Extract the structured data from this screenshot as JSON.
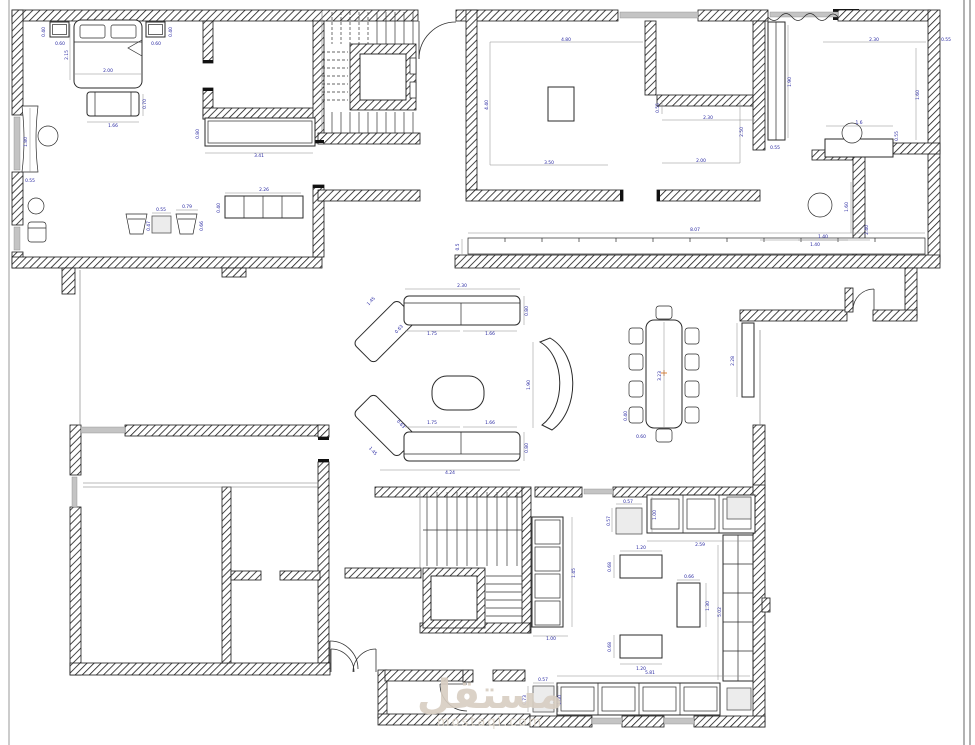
{
  "watermark": {
    "title": "مستقل",
    "domain": "mostaql.com"
  },
  "colors": {
    "dim_text": "#1f1f9e",
    "watermark": "#d8cec2",
    "center_mark": "#e0761f",
    "wall_hatch": "#1a1a1a"
  },
  "dims": {
    "bedroom": {
      "nightstand_l_d": "0.40",
      "nightstand_l_w": "0.60",
      "bed_l": "2.15",
      "bed_w": "2.00",
      "nightstand_r_w": "0.60",
      "nightstand_r_d": "0.40",
      "bench_d": "0.70",
      "bench_w": "1.66",
      "vanity_l": "1.80",
      "vanity_d": "0.55",
      "console_d": "0.80",
      "console_l": "3.41",
      "cabinet_w": "2.26",
      "cabinet_d": "0.40",
      "table_w": "0.55",
      "table_d": "0.47",
      "armchair_w": "0.79",
      "armchair_d": "0.66"
    },
    "majlis": {
      "width": "4.80",
      "height": "4.40",
      "inner": "3.50"
    },
    "closet": {
      "depth": "0.55",
      "width": "2.30",
      "height": "2.50",
      "inner": "2.00"
    },
    "dressing": {
      "width": "2.30",
      "corner": "0.55",
      "height": "1.60",
      "wardrobe_l": "1.90",
      "wardrobe_d": "0.55",
      "vanity_w": "1.6",
      "vanity_d": "0.55"
    },
    "bath": {
      "width": "1.40",
      "depth": "1.60",
      "wall": "2.40"
    },
    "corridor": {
      "length": "8.07",
      "depth": "0.5"
    },
    "vestibule": {
      "width": "1.40"
    },
    "living": {
      "sofa_top": "2.30",
      "diag": "1.45",
      "elbow": "0.63",
      "seat1": "1.75",
      "seat2": "1.66",
      "depth": "0.80",
      "diagb": "1.45",
      "elbowb": "0.63",
      "seat1b": "1.75",
      "seat2b": "1.66",
      "depthb": "0.80",
      "total": "4.24",
      "bench": "1.90"
    },
    "dining": {
      "length": "3.23",
      "chair_w": "0.40",
      "chair_d": "0.60",
      "sideboard": "2.28"
    },
    "kitchen": {
      "appl_w": "0.57",
      "appl_d": "0.57",
      "counter_d": "1.00",
      "top_len": "2.59",
      "island1_w": "1.20",
      "island1_d": "0.68",
      "cisland_w": "0.66",
      "cisland_l": "1.30",
      "island2_w": "1.20",
      "island2_d": "0.68",
      "right_len": "5.02",
      "bottom_len": "5.81",
      "cab_l": "1.45",
      "cab_w": "1.00",
      "sq_w": "0.57",
      "sq_d": "0.73",
      "sq_h": "1.00"
    }
  }
}
